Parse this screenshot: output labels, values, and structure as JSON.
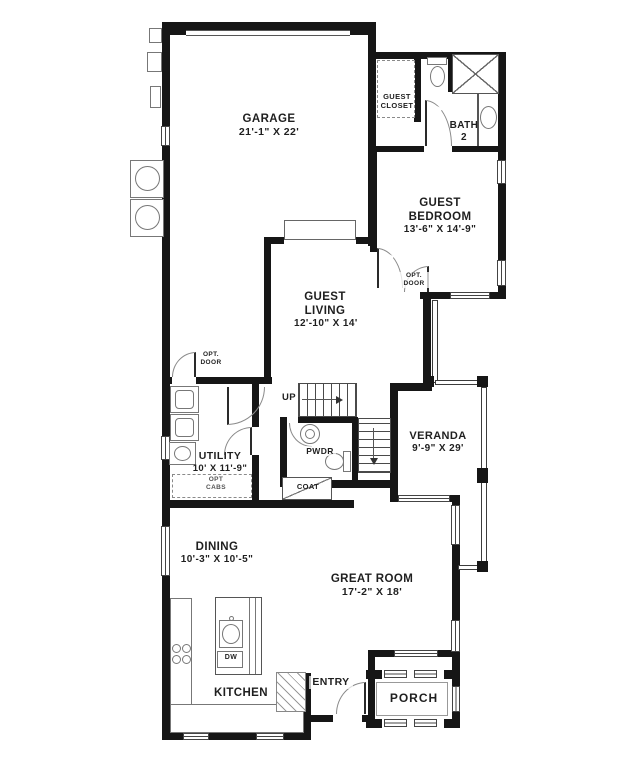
{
  "rooms": {
    "garage": {
      "name": "GARAGE",
      "dims": "21'-1\" X 22'"
    },
    "guest_closet": {
      "name": "GUEST CLOSET"
    },
    "bath2": {
      "name": "BATH",
      "dims": "2"
    },
    "guest_bedroom": {
      "name": "GUEST BEDROOM",
      "dims": "13'-6\" X 14'-9\""
    },
    "guest_living": {
      "name": "GUEST LIVING",
      "dims": "12'-10\" X 14'"
    },
    "utility": {
      "name": "UTILITY",
      "dims": "10' X 11'-9\""
    },
    "pwdr": {
      "name": "PWDR"
    },
    "coat": {
      "name": "COAT"
    },
    "veranda": {
      "name": "VERANDA",
      "dims": "9'-9\" X 29'"
    },
    "dining": {
      "name": "DINING",
      "dims": "10'-3\" X 10'-5\""
    },
    "great_room": {
      "name": "GREAT ROOM",
      "dims": "17'-2\" X 18'"
    },
    "kitchen": {
      "name": "KITCHEN"
    },
    "entry": {
      "name": "ENTRY"
    },
    "porch": {
      "name": "PORCH"
    }
  },
  "annotations": {
    "up": "UP",
    "dw": "DW",
    "opt_door_garage": "OPT. DOOR",
    "opt_door_bedroom": "OPT. DOOR",
    "opt_cabs": "OPT CABS"
  },
  "colors": {
    "wall": "#161616",
    "fixture_line": "#777777",
    "background": "#ffffff"
  }
}
